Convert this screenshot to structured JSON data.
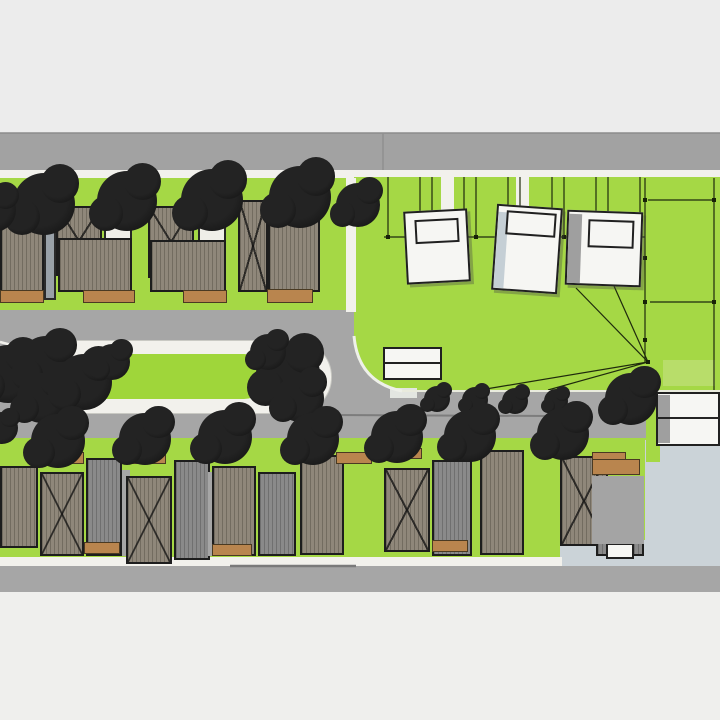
{
  "meta": {
    "scene_type": "aerial-3d-site-plan-model",
    "visible_text": ""
  },
  "scene": {
    "colors": {
      "letterTop": "#ececec",
      "letterBottom": "#efefed",
      "roadTop": "#a2a2a2",
      "road": "#a6a6a6",
      "sidewalk": "#f2f1ec",
      "grass": "#a5d845",
      "grassBright": "#9fd63a",
      "grassLight": "#b8dd6a",
      "roofTan": "#8f877a",
      "roofGray": "#8a8a8a",
      "wallGray": "#99a1a8",
      "brown": "#b9854e",
      "white": "#f6f6f3",
      "pale": "#cbd3d8",
      "shadeGray": "#9f9f9f",
      "shadeBlue": "#c5cfd5",
      "outline": "#1d1d1d",
      "lotline": "#1f2a0d"
    },
    "ground": [
      {
        "n": "letterbox-top",
        "x": 0,
        "y": 0,
        "w": 720,
        "h": 133,
        "bg": "letterTop"
      },
      {
        "n": "letterbox-bottom",
        "x": 0,
        "y": 592,
        "w": 720,
        "h": 128,
        "bg": "letterBottom"
      },
      {
        "n": "top-street",
        "x": 0,
        "y": 133,
        "w": 720,
        "h": 37,
        "bg": "roadTop"
      },
      {
        "n": "top-sidewalk",
        "x": 0,
        "y": 170,
        "w": 720,
        "h": 8,
        "bg": "sidewalk"
      },
      {
        "n": "middle-street",
        "x": 0,
        "y": 308,
        "w": 720,
        "h": 132,
        "bg": "road"
      },
      {
        "n": "front-lawns-top",
        "x": 0,
        "y": 178,
        "w": 350,
        "h": 132,
        "bg": "grass"
      },
      {
        "n": "development-field",
        "x": 354,
        "y": 177,
        "w": 366,
        "h": 215,
        "bg": "grass",
        "br": "0 0 0 55px"
      },
      {
        "n": "field-light-strip",
        "x": 663,
        "y": 360,
        "w": 52,
        "h": 26,
        "bg": "grassLight"
      },
      {
        "n": "bottom-lawns",
        "x": 0,
        "y": 438,
        "w": 652,
        "h": 120,
        "bg": "grass"
      },
      {
        "n": "paved-lot",
        "x": 645,
        "y": 440,
        "w": 75,
        "h": 126,
        "bg": "pale"
      },
      {
        "n": "paved-lot-ext",
        "x": 560,
        "y": 540,
        "w": 90,
        "h": 26,
        "bg": "pale"
      },
      {
        "n": "bottom-sidewalk",
        "x": 0,
        "y": 557,
        "w": 562,
        "h": 9,
        "bg": "sidewalk"
      },
      {
        "n": "bottom-street",
        "x": 0,
        "y": 566,
        "w": 720,
        "h": 26,
        "bg": "road"
      },
      {
        "n": "median-island-curb",
        "x": 36,
        "y": 340,
        "w": 296,
        "h": 74,
        "bg": "sidewalk",
        "br": "37px",
        "cls": "curb"
      },
      {
        "n": "median-lawn",
        "x": 82,
        "y": 354,
        "w": 184,
        "h": 45,
        "bg": "grassBright",
        "br": "22px"
      },
      {
        "n": "right-green-strip",
        "x": 646,
        "y": 390,
        "w": 14,
        "h": 72,
        "bg": "grass"
      },
      {
        "n": "top-driveway-gap-1",
        "x": 441,
        "y": 177,
        "w": 13,
        "h": 34,
        "bg": "sidewalk"
      },
      {
        "n": "top-driveway-gap-2",
        "x": 516,
        "y": 177,
        "w": 13,
        "h": 31,
        "bg": "sidewalk"
      },
      {
        "n": "left-driveway-strip",
        "x": 346,
        "y": 178,
        "w": 10,
        "h": 134,
        "bg": "sidewalk"
      },
      {
        "n": "curb-cut-pad",
        "x": 390,
        "y": 388,
        "w": 27,
        "h": 10,
        "bg": "#e3e6e1"
      }
    ],
    "field_verticals": [
      388,
      420,
      432,
      464,
      476,
      508,
      520,
      552,
      564,
      596,
      608,
      640
    ],
    "rays_origin": [
      648,
      362
    ],
    "rays": [
      [
        576,
        288
      ],
      [
        614,
        286
      ],
      [
        474,
        391
      ],
      [
        548,
        390
      ]
    ],
    "lines": [
      {
        "x1": 0,
        "y1": 133,
        "x2": 720,
        "y2": 133,
        "s": "#8b8b8b",
        "w": 1.5
      },
      {
        "x1": 383,
        "y1": 133,
        "x2": 383,
        "y2": 170,
        "s": "#8f8f8f",
        "w": 1.5
      },
      {
        "x1": 384,
        "y1": 237,
        "x2": 645,
        "y2": 237
      },
      {
        "x1": 648,
        "y1": 200,
        "x2": 714,
        "y2": 200
      },
      {
        "x1": 650,
        "y1": 302,
        "x2": 714,
        "y2": 302
      },
      {
        "x1": 645,
        "y1": 178,
        "x2": 645,
        "y2": 362
      },
      {
        "x1": 714,
        "y1": 178,
        "x2": 714,
        "y2": 390
      },
      {
        "x1": 402,
        "y1": 391,
        "x2": 720,
        "y2": 391,
        "s": "#e9ebdd",
        "w": 2
      },
      {
        "x1": 332,
        "y1": 415,
        "x2": 548,
        "y2": 416,
        "s": "#7d7d7d",
        "w": 2
      },
      {
        "x1": 230,
        "y1": 566,
        "x2": 356,
        "y2": 566,
        "s": "#7a7a7a",
        "w": 2.5
      },
      {
        "x1": 0,
        "y1": 342,
        "x2": 38,
        "y2": 352,
        "s": "#f2f1ec",
        "w": 2.5
      },
      {
        "x1": 0,
        "y1": 416,
        "x2": 36,
        "y2": 406,
        "s": "#f2f1ec",
        "w": 2.5
      }
    ],
    "paths": [
      {
        "d": "M354,336 Q358,382 402,391",
        "s": "#eef0e9",
        "w": 3
      }
    ],
    "nodes": [
      [
        388,
        237
      ],
      [
        420,
        237
      ],
      [
        432,
        237
      ],
      [
        464,
        237
      ],
      [
        476,
        237
      ],
      [
        508,
        237
      ],
      [
        520,
        237
      ],
      [
        552,
        237
      ],
      [
        564,
        237
      ],
      [
        596,
        237
      ],
      [
        608,
        237
      ],
      [
        640,
        237
      ],
      [
        645,
        200
      ],
      [
        714,
        200
      ],
      [
        645,
        258
      ],
      [
        645,
        302
      ],
      [
        645,
        340
      ],
      [
        714,
        302
      ],
      [
        648,
        362
      ]
    ],
    "masses": [
      {
        "n": "house-roof",
        "cls": "roof",
        "x": 0,
        "y": 218,
        "w": 44,
        "h": 74
      },
      {
        "n": "house-wall",
        "cls": "wall",
        "x": 44,
        "y": 216,
        "w": 12,
        "h": 84
      },
      {
        "n": "gabled-house",
        "cls": "gable",
        "x": 56,
        "y": 206,
        "w": 46,
        "h": 70
      },
      {
        "n": "house-annex",
        "cls": "annex",
        "x": 104,
        "y": 216,
        "w": 28,
        "h": 26
      },
      {
        "n": "house-roof",
        "cls": "roof",
        "x": 58,
        "y": 238,
        "w": 74,
        "h": 54
      },
      {
        "n": "gabled-house",
        "cls": "gable",
        "x": 148,
        "y": 206,
        "w": 46,
        "h": 72
      },
      {
        "n": "house-annex",
        "cls": "annex",
        "x": 198,
        "y": 218,
        "w": 28,
        "h": 26
      },
      {
        "n": "house-roof",
        "cls": "roof",
        "x": 150,
        "y": 240,
        "w": 76,
        "h": 52
      },
      {
        "n": "gabled-house",
        "cls": "gable",
        "x": 238,
        "y": 200,
        "w": 30,
        "h": 92
      },
      {
        "n": "house-roof",
        "cls": "roof",
        "x": 268,
        "y": 214,
        "w": 52,
        "h": 78
      },
      {
        "n": "driveway-pad",
        "cls": "pad",
        "x": 0,
        "y": 290,
        "w": 44,
        "h": 13
      },
      {
        "n": "driveway-pad",
        "cls": "pad",
        "x": 83,
        "y": 290,
        "w": 52,
        "h": 13
      },
      {
        "n": "driveway-pad",
        "cls": "pad",
        "x": 183,
        "y": 290,
        "w": 44,
        "h": 13
      },
      {
        "n": "driveway-pad",
        "cls": "pad",
        "x": 267,
        "y": 289,
        "w": 46,
        "h": 14
      },
      {
        "n": "house-roof",
        "cls": "roof",
        "x": 0,
        "y": 466,
        "w": 38,
        "h": 82
      },
      {
        "n": "gabled-house",
        "cls": "gable",
        "x": 40,
        "y": 472,
        "w": 44,
        "h": 84
      },
      {
        "n": "garage-roof",
        "cls": "roofg",
        "x": 86,
        "y": 458,
        "w": 36,
        "h": 98
      },
      {
        "n": "side-path",
        "x": 122,
        "y": 470,
        "w": 8,
        "h": 86,
        "bg": "road"
      },
      {
        "n": "gabled-house",
        "cls": "gable",
        "x": 126,
        "y": 476,
        "w": 46,
        "h": 88
      },
      {
        "n": "garage-roof",
        "cls": "roofg",
        "x": 174,
        "y": 460,
        "w": 36,
        "h": 100
      },
      {
        "n": "side-path",
        "x": 208,
        "y": 472,
        "w": 8,
        "h": 84,
        "bg": "road"
      },
      {
        "n": "house-roof",
        "cls": "roof",
        "x": 212,
        "y": 466,
        "w": 44,
        "h": 90
      },
      {
        "n": "garage-roof",
        "cls": "roofg",
        "x": 258,
        "y": 472,
        "w": 38,
        "h": 84
      },
      {
        "n": "house-roof",
        "cls": "roof",
        "x": 300,
        "y": 455,
        "w": 44,
        "h": 100
      },
      {
        "n": "gabled-house",
        "cls": "gable",
        "x": 384,
        "y": 468,
        "w": 46,
        "h": 84
      },
      {
        "n": "garage-roof",
        "cls": "roofg",
        "x": 432,
        "y": 460,
        "w": 40,
        "h": 96
      },
      {
        "n": "house-roof",
        "cls": "roof",
        "x": 480,
        "y": 450,
        "w": 44,
        "h": 105
      },
      {
        "n": "gabled-house",
        "cls": "gable",
        "x": 560,
        "y": 456,
        "w": 48,
        "h": 90
      },
      {
        "n": "garage-roof",
        "cls": "roofg",
        "x": 596,
        "y": 476,
        "w": 48,
        "h": 80
      },
      {
        "n": "house-wall",
        "cls": "wall",
        "x": 610,
        "y": 506,
        "w": 22,
        "h": 38
      },
      {
        "n": "driveway-pad",
        "cls": "pad",
        "x": 44,
        "y": 452,
        "w": 40,
        "h": 12
      },
      {
        "n": "driveway-pad",
        "cls": "pad",
        "x": 126,
        "y": 452,
        "w": 40,
        "h": 12
      },
      {
        "n": "driveway-pad",
        "cls": "pad",
        "x": 336,
        "y": 452,
        "w": 36,
        "h": 12
      },
      {
        "n": "driveway-pad",
        "cls": "pad",
        "x": 388,
        "y": 448,
        "w": 34,
        "h": 11
      },
      {
        "n": "driveway-pad",
        "cls": "pad",
        "x": 592,
        "y": 452,
        "w": 34,
        "h": 12
      },
      {
        "n": "driveway-pad",
        "cls": "pad",
        "x": 84,
        "y": 542,
        "w": 36,
        "h": 12
      },
      {
        "n": "driveway-pad",
        "cls": "pad",
        "x": 212,
        "y": 544,
        "w": 40,
        "h": 12
      },
      {
        "n": "driveway-pad",
        "cls": "pad",
        "x": 432,
        "y": 540,
        "w": 36,
        "h": 12
      },
      {
        "n": "white-pad",
        "cls": "whitebldg",
        "x": 606,
        "y": 543,
        "w": 28,
        "h": 16
      },
      {
        "n": "right-lot-pad",
        "cls": "pad",
        "x": 592,
        "y": 459,
        "w": 48,
        "h": 16
      },
      {
        "n": "right-lot-paving",
        "x": 592,
        "y": 476,
        "w": 52,
        "h": 68,
        "bg": "#a4a4a4"
      },
      {
        "n": "unbuilt-building-1",
        "cls": "whitebldg bldg3d",
        "x": 405,
        "y": 210,
        "w": 64,
        "h": 73,
        "rot": -3
      },
      {
        "n": "building-1-roof-step",
        "cls": "inner",
        "x": 415,
        "y": 219,
        "w": 44,
        "h": 24,
        "rot": -3
      },
      {
        "n": "unbuilt-building-2",
        "cls": "whitebldg bldg3d",
        "x": 494,
        "y": 206,
        "w": 66,
        "h": 86,
        "rot": 4
      },
      {
        "n": "building-2-shade",
        "x": 496,
        "y": 212,
        "w": 10,
        "h": 76,
        "bg": "shadeBlue",
        "rot": 4
      },
      {
        "n": "building-2-roof-step",
        "cls": "inner",
        "x": 506,
        "y": 212,
        "w": 50,
        "h": 24,
        "rot": 4
      },
      {
        "n": "unbuilt-building-3",
        "cls": "whitebldg bldg3d",
        "x": 566,
        "y": 211,
        "w": 76,
        "h": 75,
        "rot": 2
      },
      {
        "n": "building-3-shade",
        "x": 568,
        "y": 214,
        "w": 13,
        "h": 69,
        "bg": "shadeGray",
        "rot": 2
      },
      {
        "n": "building-3-roof-step",
        "cls": "inner",
        "x": 588,
        "y": 220,
        "w": 46,
        "h": 28,
        "rot": 2
      },
      {
        "n": "garden-structure-top",
        "cls": "whitebldg",
        "x": 383,
        "y": 347,
        "w": 59,
        "h": 17
      },
      {
        "n": "garden-structure-bottom",
        "cls": "whitebldg",
        "x": 383,
        "y": 362,
        "w": 59,
        "h": 18
      },
      {
        "n": "white-building-right",
        "cls": "whitebldg",
        "x": 656,
        "y": 392,
        "w": 64,
        "h": 54
      },
      {
        "n": "building-right-shade",
        "x": 658,
        "y": 395,
        "w": 12,
        "h": 48,
        "bg": "shadeGray"
      },
      {
        "n": "building-right-divider",
        "x": 657,
        "y": 417,
        "w": 62,
        "h": 2,
        "bg": "#242424"
      }
    ],
    "canopy": [
      {
        "n": "street-tree",
        "x": 13,
        "y": 173,
        "w": 62,
        "h": 62
      },
      {
        "n": "street-tree",
        "x": 97,
        "y": 171,
        "w": 60,
        "h": 60
      },
      {
        "n": "street-tree",
        "x": 181,
        "y": 169,
        "w": 62,
        "h": 62
      },
      {
        "n": "street-tree",
        "x": 269,
        "y": 166,
        "w": 62,
        "h": 62
      },
      {
        "n": "street-tree",
        "x": 336,
        "y": 183,
        "w": 44,
        "h": 44
      },
      {
        "n": "street-tree",
        "x": -28,
        "y": 188,
        "w": 44,
        "h": 44
      },
      {
        "n": "median-tree",
        "x": -21,
        "y": 345,
        "w": 58,
        "h": 58
      },
      {
        "n": "median-tree",
        "x": 19,
        "y": 336,
        "w": 54,
        "h": 54
      },
      {
        "n": "median-tree",
        "x": 17,
        "y": 373,
        "w": 50,
        "h": 50
      },
      {
        "n": "median-tree",
        "x": 56,
        "y": 354,
        "w": 56,
        "h": 56
      },
      {
        "n": "median-tree",
        "x": 94,
        "y": 344,
        "w": 36,
        "h": 36
      },
      {
        "n": "median-tree",
        "x": 256,
        "y": 342,
        "w": 64,
        "h": 64
      },
      {
        "n": "median-tree",
        "x": 276,
        "y": 374,
        "w": 48,
        "h": 48
      },
      {
        "n": "median-tree",
        "x": 250,
        "y": 334,
        "w": 36,
        "h": 36
      },
      {
        "n": "young-street-tree",
        "x": 424,
        "y": 386,
        "w": 26,
        "h": 26
      },
      {
        "n": "young-street-tree",
        "x": 462,
        "y": 387,
        "w": 26,
        "h": 26
      },
      {
        "n": "young-street-tree",
        "x": 502,
        "y": 388,
        "w": 26,
        "h": 26
      },
      {
        "n": "young-street-tree",
        "x": 544,
        "y": 389,
        "w": 24,
        "h": 24
      },
      {
        "n": "street-tree",
        "x": 605,
        "y": 373,
        "w": 52,
        "h": 52
      },
      {
        "n": "yard-tree",
        "x": 31,
        "y": 414,
        "w": 54,
        "h": 54
      },
      {
        "n": "yard-tree",
        "x": 119,
        "y": 413,
        "w": 52,
        "h": 52
      },
      {
        "n": "yard-tree",
        "x": 198,
        "y": 410,
        "w": 54,
        "h": 54
      },
      {
        "n": "yard-tree",
        "x": 287,
        "y": 413,
        "w": 52,
        "h": 52
      },
      {
        "n": "yard-tree",
        "x": 371,
        "y": 411,
        "w": 52,
        "h": 52
      },
      {
        "n": "yard-tree",
        "x": 444,
        "y": 410,
        "w": 52,
        "h": 52
      },
      {
        "n": "yard-tree",
        "x": 537,
        "y": 408,
        "w": 52,
        "h": 52
      },
      {
        "n": "yard-tree",
        "x": -14,
        "y": 412,
        "w": 32,
        "h": 32
      }
    ]
  }
}
